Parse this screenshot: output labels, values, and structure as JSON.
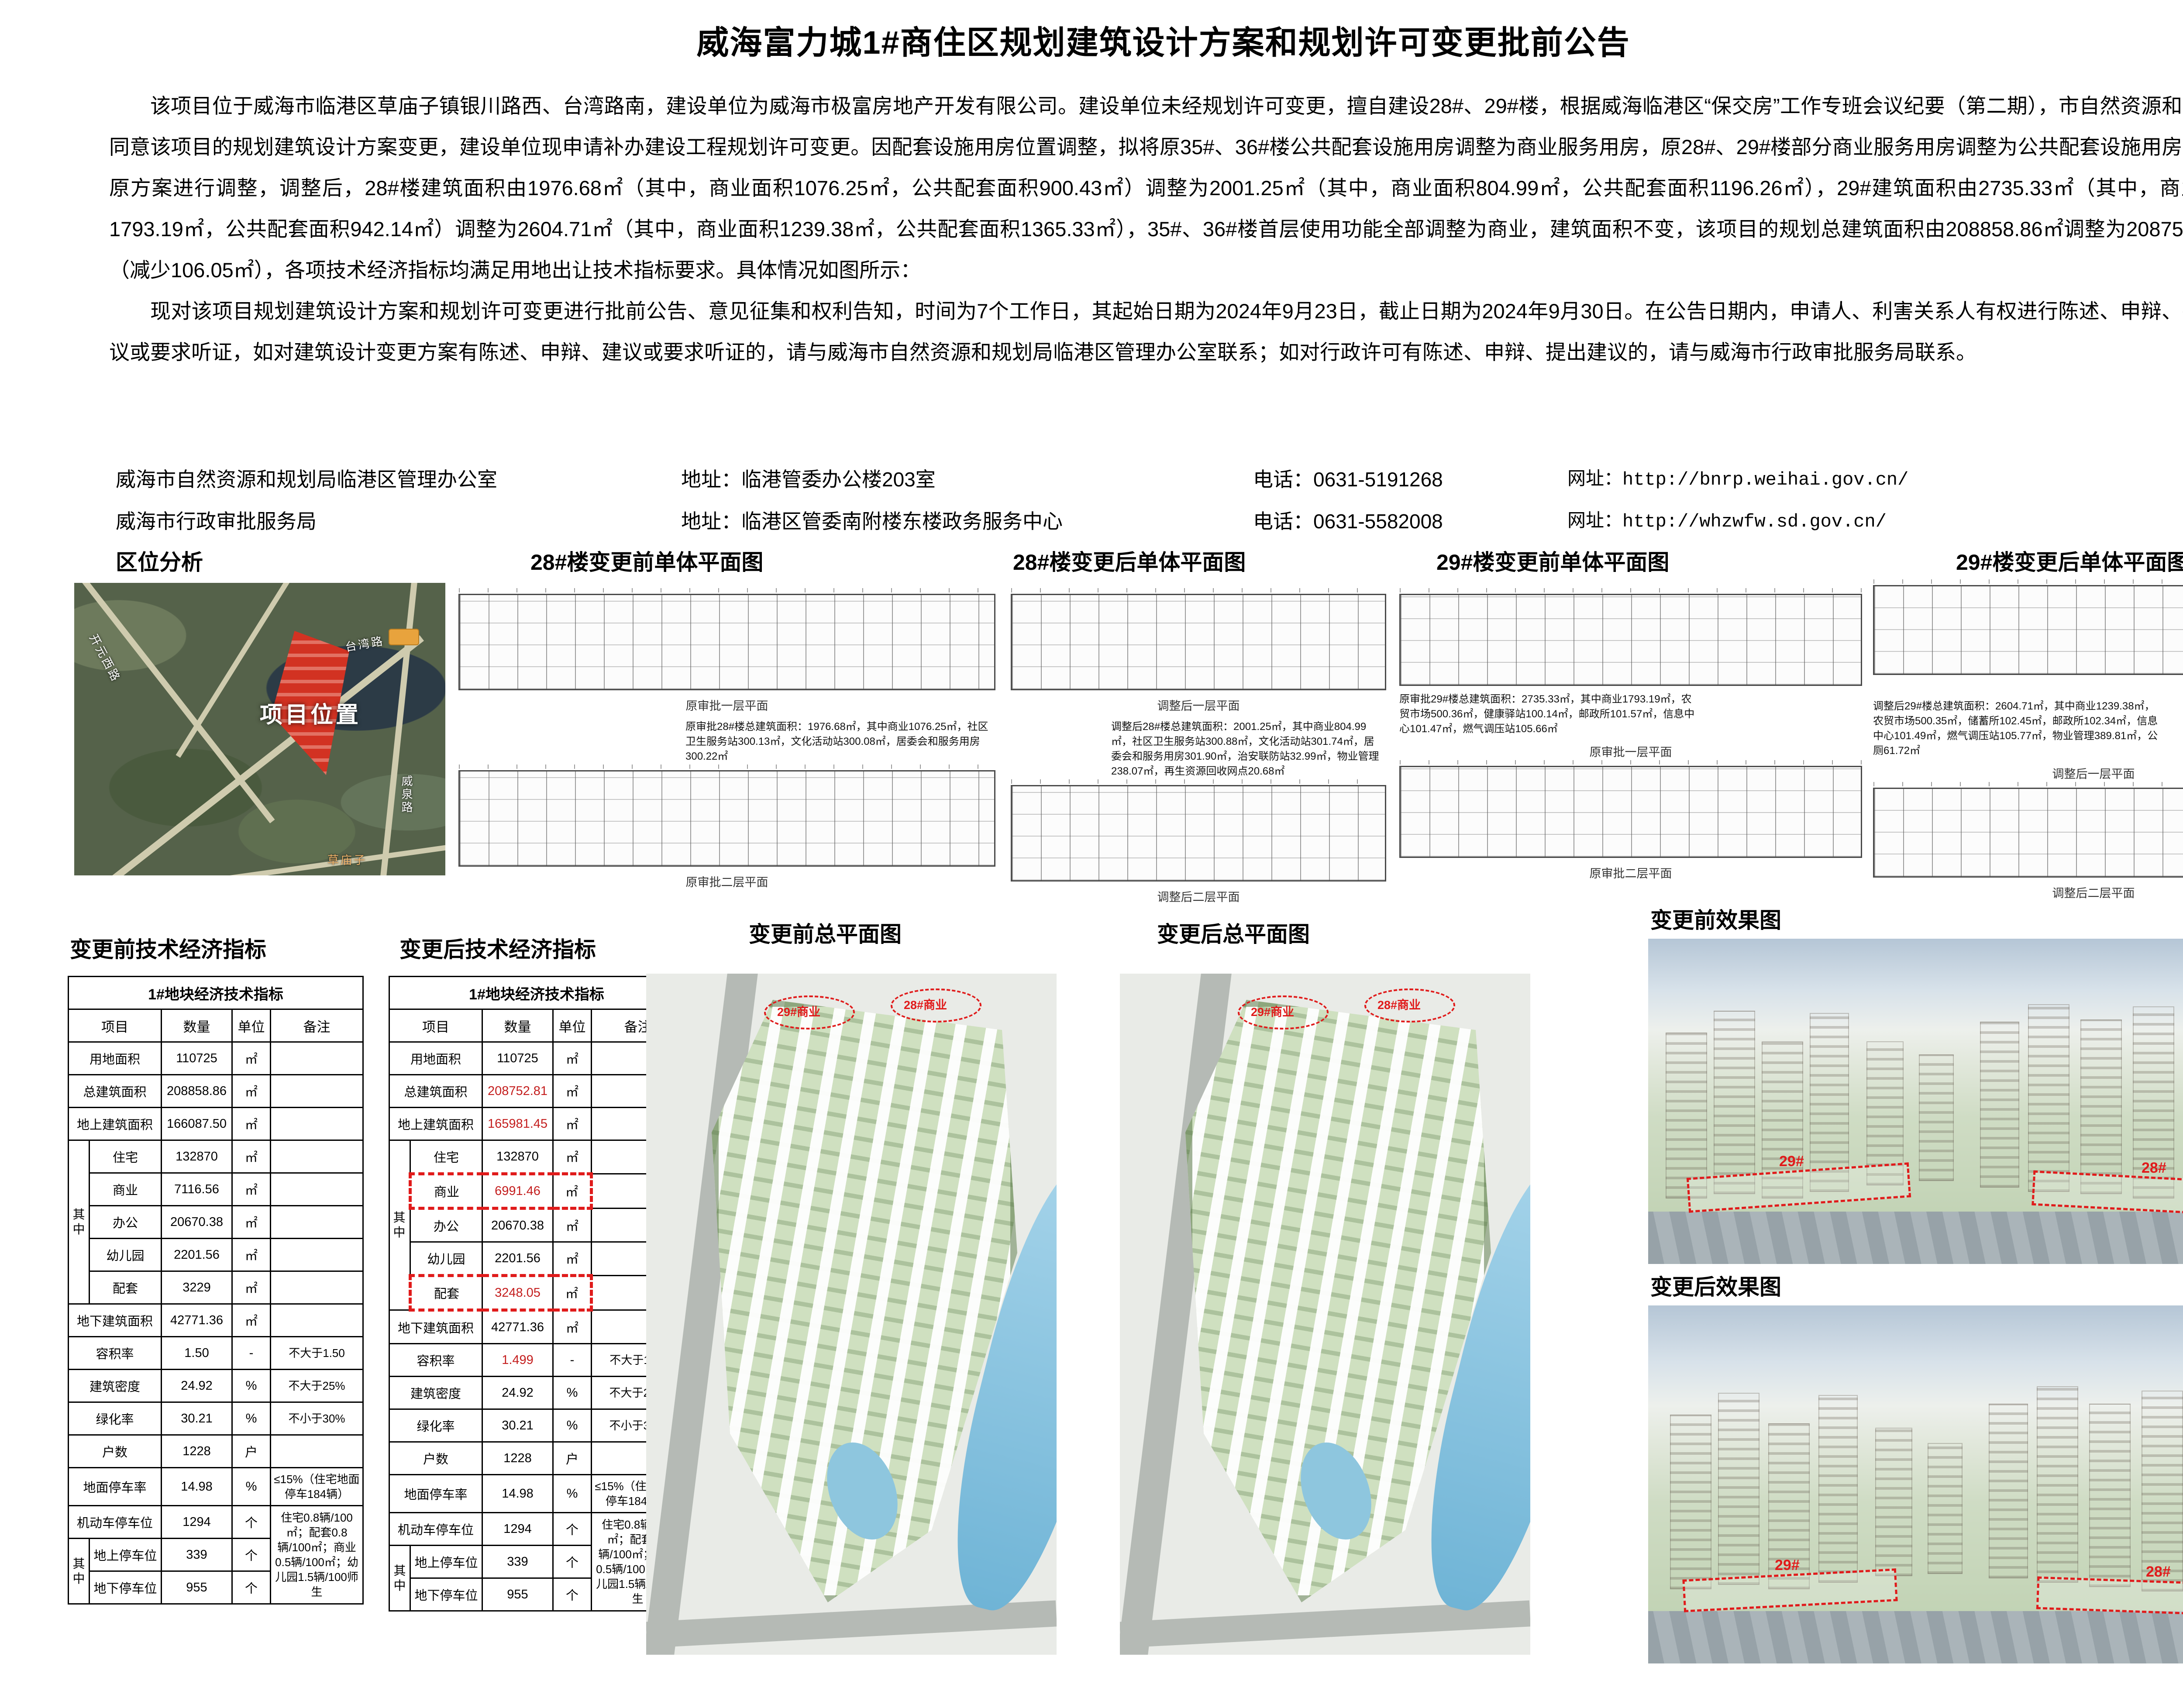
{
  "title": "威海富力城1#商住区规划建筑设计方案和规划许可变更批前公告",
  "paragraphs": [
    "该项目位于威海市临港区草庙子镇银川路西、台湾路南，建设单位为威海市极富房地产开发有限公司。建设单位未经规划许可变更，擅自建设28#、29#楼，根据威海临港区“保交房”工作专班会议纪要（第二期），市自然资源和规划局同意该项目的规划建筑设计方案变更，建设单位现申请补办建设工程规划许可变更。因配套设施用房位置调整，拟将原35#、36#楼公共配套设施用房调整为商业服务用房，原28#、29#楼部分商业服务用房调整为公共配套设施用房，故对原方案进行调整，调整后，28#楼建筑面积由1976.68㎡（其中，商业面积1076.25㎡，公共配套面积900.43㎡）调整为2001.25㎡（其中，商业面积804.99㎡，公共配套面积1196.26㎡），29#建筑面积由2735.33㎡（其中，商业面积1793.19㎡，公共配套面积942.14㎡）调整为2604.71㎡（其中，商业面积1239.38㎡，公共配套面积1365.33㎡），35#、36#楼首层使用功能全部调整为商业，建筑面积不变，该项目的规划总建筑面积由208858.86㎡调整为208752.81㎡（减少106.05㎡），各项技术经济指标均满足用地出让技术指标要求。具体情况如图所示：",
    "现对该项目规划建筑设计方案和规划许可变更进行批前公告、意见征集和权利告知，时间为7个工作日，其起始日期为2024年9月23日，截止日期为2024年9月30日。在公告日期内，申请人、利害关系人有权进行陈述、申辩、提出建议或要求听证，如对建筑设计变更方案有陈述、申辩、建议或要求听证的，请与威海市自然资源和规划局临港区管理办公室联系；如对行政许可有陈述、申辩、提出建议的，请与威海市行政审批服务局联系。"
  ],
  "contacts": [
    {
      "org": "威海市自然资源和规划局临港区管理办公室",
      "address": "地址：临港管委办公楼203室",
      "phone": "电话：0631-5191268",
      "website": "网址：http://bnrp.weihai.gov.cn/"
    },
    {
      "org": "威海市行政审批服务局",
      "address": "地址：临港区管委南附楼东楼政务服务中心",
      "phone": "电话：0631-5582008",
      "website": "网址：http://whzwfw.sd.gov.cn/"
    }
  ],
  "sections": {
    "location": "区位分析",
    "p28_before": "28#楼变更前单体平面图",
    "p28_after": "28#楼变更后单体平面图",
    "p29_before": "29#楼变更前单体平面图",
    "p29_after": "29#楼变更后单体平面图",
    "table_before": "变更前技术经济指标",
    "table_after": "变更后技术经济指标",
    "site_before": "变更前总平面图",
    "site_after": "变更后总平面图",
    "render_before": "变更前效果图",
    "render_after": "变更后效果图"
  },
  "map": {
    "project_label": "项目位置",
    "roads": [
      "台湾路",
      "开元西路",
      "威泉路",
      "草庙子"
    ]
  },
  "floorplans": {
    "b28_before": {
      "caption": "原审批28#楼总建筑面积：1976.68㎡，其中商业1076.25㎡，社区卫生服务站300.13㎡，文化活动站300.08㎡，居委会和服务用房300.22㎡",
      "level1": "原审批一层平面",
      "level2": "原审批二层平面"
    },
    "b28_after": {
      "caption": "调整后28#楼总建筑面积：2001.25㎡，其中商业804.99㎡，社区卫生服务站300.88㎡，文化活动站301.74㎡，居委会和服务用房301.90㎡，治安联防站32.99㎡，物业管理238.07㎡，再生资源回收网点20.68㎡",
      "level1": "调整后一层平面",
      "level2": "调整后二层平面"
    },
    "b29_before": {
      "caption": "原审批29#楼总建筑面积：2735.33㎡，其中商业1793.19㎡，农贸市场500.36㎡，健康驿站100.14㎡，邮政所101.57㎡，信息中心101.47㎡，燃气调压站105.66㎡",
      "level1": "原审批一层平面",
      "level2": "原审批二层平面"
    },
    "b29_after": {
      "caption": "调整后29#楼总建筑面积：2604.71㎡，其中商业1239.38㎡，农贸市场500.35㎡，储蓄所102.45㎡，邮政所102.34㎡，信息中心101.49㎡，燃气调压站105.77㎡，物业管理389.81㎡，公厕61.72㎡",
      "level1": "调整后一层平面",
      "level2": "调整后二层平面",
      "corner": "首层平面图"
    }
  },
  "tables": {
    "before": {
      "title": "1#地块经济技术指标",
      "headers": [
        "项目",
        "数量",
        "单位",
        "备注"
      ],
      "group1": "其中",
      "group2": "其中",
      "rows": [
        {
          "label": "用地面积",
          "value": "110725",
          "unit": "㎡",
          "remark": ""
        },
        {
          "label": "总建筑面积",
          "value": "208858.86",
          "unit": "㎡",
          "remark": ""
        },
        {
          "label": "地上建筑面积",
          "value": "166087.50",
          "unit": "㎡",
          "remark": ""
        },
        {
          "label": "住宅",
          "value": "132870",
          "unit": "㎡",
          "remark": ""
        },
        {
          "label": "商业",
          "value": "7116.56",
          "unit": "㎡",
          "remark": ""
        },
        {
          "label": "办公",
          "value": "20670.38",
          "unit": "㎡",
          "remark": ""
        },
        {
          "label": "幼儿园",
          "value": "2201.56",
          "unit": "㎡",
          "remark": ""
        },
        {
          "label": "配套",
          "value": "3229",
          "unit": "㎡",
          "remark": ""
        },
        {
          "label": "地下建筑面积",
          "value": "42771.36",
          "unit": "㎡",
          "remark": ""
        },
        {
          "label": "容积率",
          "value": "1.50",
          "unit": "-",
          "remark": "不大于1.50"
        },
        {
          "label": "建筑密度",
          "value": "24.92",
          "unit": "%",
          "remark": "不大于25%"
        },
        {
          "label": "绿化率",
          "value": "30.21",
          "unit": "%",
          "remark": "不小于30%"
        },
        {
          "label": "户数",
          "value": "1228",
          "unit": "户",
          "remark": ""
        },
        {
          "label": "地面停车率",
          "value": "14.98",
          "unit": "%",
          "remark": "≤15%（住宅地面停车184辆）"
        },
        {
          "label": "机动车停车位",
          "value": "1294",
          "unit": "个",
          "remark": "住宅0.8辆/100㎡；配套0.8辆/100㎡；商业0.5辆/100㎡；幼儿园1.5辆/100师生"
        },
        {
          "label": "地上停车位",
          "value": "339",
          "unit": "个"
        },
        {
          "label": "地下停车位",
          "value": "955",
          "unit": "个"
        }
      ]
    },
    "after": {
      "title": "1#地块经济技术指标",
      "headers": [
        "项目",
        "数量",
        "单位",
        "备注"
      ],
      "group1": "其中",
      "group2": "其中",
      "rows": [
        {
          "label": "用地面积",
          "value": "110725",
          "unit": "㎡",
          "remark": ""
        },
        {
          "label": "总建筑面积",
          "value": "208752.81",
          "unit": "㎡",
          "remark": ""
        },
        {
          "label": "地上建筑面积",
          "value": "165981.45",
          "unit": "㎡",
          "remark": ""
        },
        {
          "label": "住宅",
          "value": "132870",
          "unit": "㎡",
          "remark": ""
        },
        {
          "label": "商业",
          "value": "6991.46",
          "unit": "㎡",
          "remark": ""
        },
        {
          "label": "办公",
          "value": "20670.38",
          "unit": "㎡",
          "remark": ""
        },
        {
          "label": "幼儿园",
          "value": "2201.56",
          "unit": "㎡",
          "remark": ""
        },
        {
          "label": "配套",
          "value": "3248.05",
          "unit": "㎡",
          "remark": ""
        },
        {
          "label": "地下建筑面积",
          "value": "42771.36",
          "unit": "㎡",
          "remark": ""
        },
        {
          "label": "容积率",
          "value": "1.499",
          "unit": "-",
          "remark": "不大于1.50"
        },
        {
          "label": "建筑密度",
          "value": "24.92",
          "unit": "%",
          "remark": "不大于25%"
        },
        {
          "label": "绿化率",
          "value": "30.21",
          "unit": "%",
          "remark": "不小于30%"
        },
        {
          "label": "户数",
          "value": "1228",
          "unit": "户",
          "remark": ""
        },
        {
          "label": "地面停车率",
          "value": "14.98",
          "unit": "%",
          "remark": "≤15%（住宅地面停车184辆）"
        },
        {
          "label": "机动车停车位",
          "value": "1294",
          "unit": "个",
          "remark": "住宅0.8辆/100㎡；配套0.8辆/100㎡；商业0.5辆/100㎡；幼儿园1.5辆/100师生"
        },
        {
          "label": "地上停车位",
          "value": "339",
          "unit": "个"
        },
        {
          "label": "地下停车位",
          "value": "955",
          "unit": "个"
        }
      ]
    }
  },
  "siteplan": {
    "tags": [
      "29#商业",
      "28#商业"
    ]
  },
  "renders": {
    "tags": [
      "29#",
      "28#"
    ]
  }
}
